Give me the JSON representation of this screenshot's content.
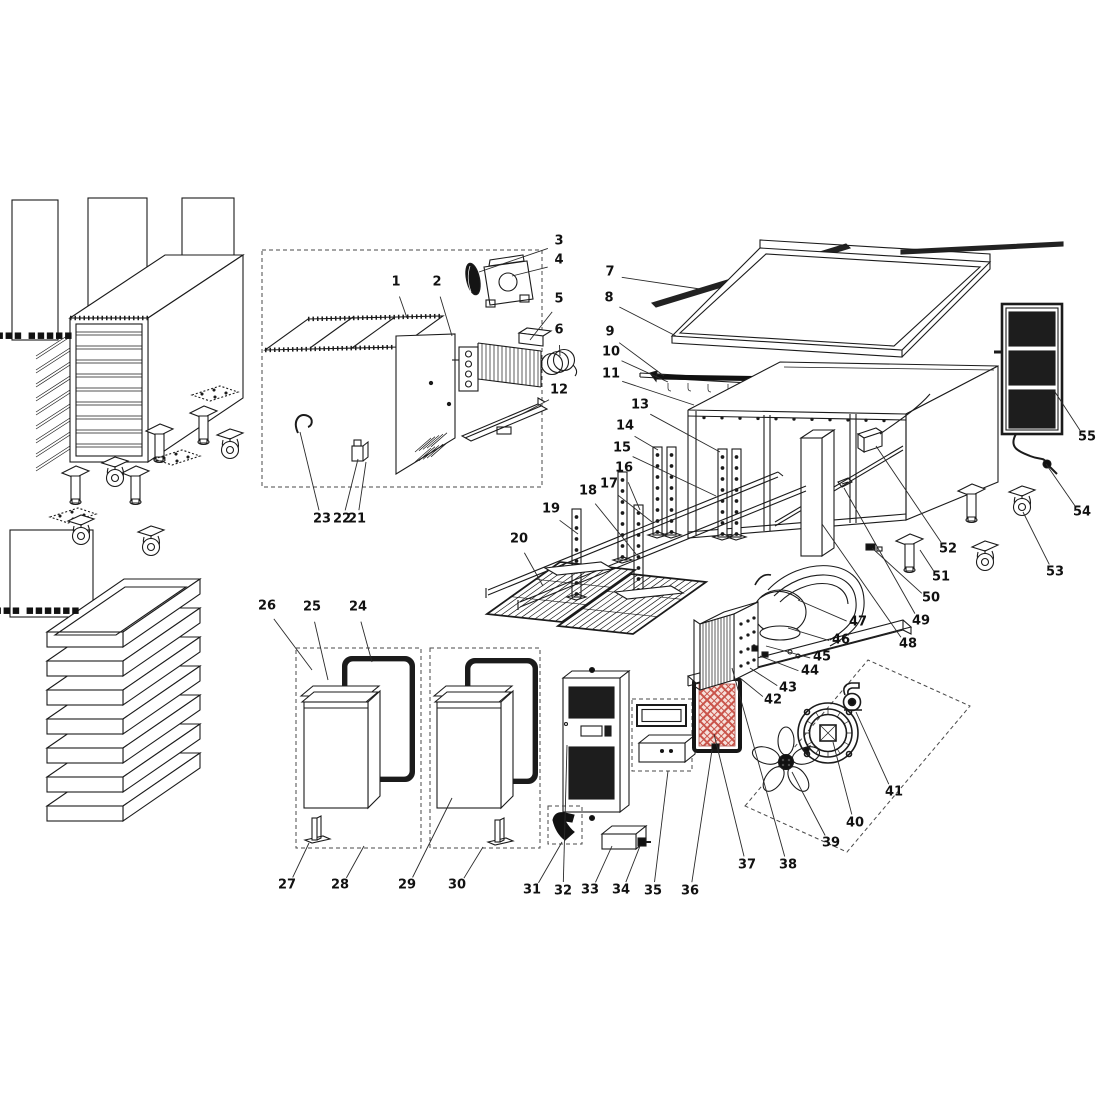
{
  "canvas": {
    "width": 1100,
    "height": 1100,
    "background": "#ffffff",
    "line_color": "#1b1b1b",
    "leader_color": "#2a2a2a",
    "label_color": "#111111",
    "filter_lattice_red": "#c9544a",
    "filter_lattice_bg": "#f6e0da",
    "mesh_dark": "#1d1d1d"
  },
  "diagram": {
    "kind": "exploded-parts-diagram",
    "subject": "commercial refrigerated worktable exploded view",
    "projection": "isometric technical line drawing",
    "part_count": 55
  },
  "fine_print": [
    {
      "text": "▪▪▪▪▪▪▪ ▪▪▪▪▪",
      "x": 16,
      "y": 339
    },
    {
      "text": "▪▪▪▪▪▪▪▪ ▪▪▪▪▪▪",
      "x": 14,
      "y": 614
    }
  ],
  "parts": [
    {
      "n": "1",
      "x": 396,
      "y": 281,
      "tx": 407,
      "ty": 318
    },
    {
      "n": "2",
      "x": 437,
      "y": 281,
      "tx": 452,
      "ty": 336
    },
    {
      "n": "3",
      "x": 559,
      "y": 240,
      "tx": 479,
      "ty": 272
    },
    {
      "n": "4",
      "x": 559,
      "y": 259,
      "tx": 512,
      "ty": 276
    },
    {
      "n": "5",
      "x": 559,
      "y": 298,
      "tx": 530,
      "ty": 340
    },
    {
      "n": "6",
      "x": 559,
      "y": 329,
      "tx": 560,
      "ty": 356
    },
    {
      "n": "7",
      "x": 610,
      "y": 271,
      "tx": 700,
      "ty": 289
    },
    {
      "n": "8",
      "x": 609,
      "y": 297,
      "tx": 676,
      "ty": 336
    },
    {
      "n": "9",
      "x": 610,
      "y": 331,
      "tx": 664,
      "ty": 376
    },
    {
      "n": "10",
      "x": 611,
      "y": 351,
      "tx": 668,
      "ty": 382
    },
    {
      "n": "11",
      "x": 611,
      "y": 373,
      "tx": 694,
      "ty": 405
    },
    {
      "n": "12",
      "x": 559,
      "y": 389,
      "tx": 522,
      "ty": 414
    },
    {
      "n": "13",
      "x": 640,
      "y": 404,
      "tx": 720,
      "ty": 452
    },
    {
      "n": "14",
      "x": 625,
      "y": 425,
      "tx": 658,
      "ty": 450
    },
    {
      "n": "15",
      "x": 622,
      "y": 447,
      "tx": 716,
      "ty": 496
    },
    {
      "n": "16",
      "x": 624,
      "y": 467,
      "tx": 640,
      "ty": 510
    },
    {
      "n": "17",
      "x": 609,
      "y": 483,
      "tx": 652,
      "ty": 522
    },
    {
      "n": "18",
      "x": 588,
      "y": 490,
      "tx": 636,
      "ty": 554
    },
    {
      "n": "19",
      "x": 551,
      "y": 508,
      "tx": 578,
      "ty": 534
    },
    {
      "n": "20",
      "x": 519,
      "y": 538,
      "tx": 543,
      "ty": 586
    },
    {
      "n": "21",
      "x": 357,
      "y": 518,
      "tx": 366,
      "ty": 462
    },
    {
      "n": "22",
      "x": 342,
      "y": 518,
      "tx": 358,
      "ty": 459
    },
    {
      "n": "23",
      "x": 322,
      "y": 518,
      "tx": 300,
      "ty": 432
    },
    {
      "n": "24",
      "x": 358,
      "y": 606,
      "tx": 372,
      "ty": 662
    },
    {
      "n": "25",
      "x": 312,
      "y": 606,
      "tx": 328,
      "ty": 680
    },
    {
      "n": "26",
      "x": 267,
      "y": 605,
      "tx": 312,
      "ty": 670
    },
    {
      "n": "27",
      "x": 287,
      "y": 884,
      "tx": 309,
      "ty": 843
    },
    {
      "n": "28",
      "x": 340,
      "y": 884,
      "tx": 364,
      "ty": 846
    },
    {
      "n": "29",
      "x": 407,
      "y": 884,
      "tx": 452,
      "ty": 798
    },
    {
      "n": "30",
      "x": 457,
      "y": 884,
      "tx": 483,
      "ty": 847
    },
    {
      "n": "31",
      "x": 532,
      "y": 889,
      "tx": 562,
      "ty": 842
    },
    {
      "n": "32",
      "x": 563,
      "y": 890,
      "tx": 567,
      "ty": 745
    },
    {
      "n": "33",
      "x": 590,
      "y": 889,
      "tx": 612,
      "ty": 846
    },
    {
      "n": "34",
      "x": 621,
      "y": 889,
      "tx": 640,
      "ty": 846
    },
    {
      "n": "35",
      "x": 653,
      "y": 890,
      "tx": 668,
      "ty": 771
    },
    {
      "n": "36",
      "x": 690,
      "y": 890,
      "tx": 712,
      "ty": 750
    },
    {
      "n": "37",
      "x": 747,
      "y": 864,
      "tx": 714,
      "ty": 734
    },
    {
      "n": "38",
      "x": 788,
      "y": 864,
      "tx": 732,
      "ty": 668
    },
    {
      "n": "39",
      "x": 831,
      "y": 842,
      "tx": 792,
      "ty": 772
    },
    {
      "n": "40",
      "x": 855,
      "y": 822,
      "tx": 833,
      "ty": 742
    },
    {
      "n": "41",
      "x": 894,
      "y": 791,
      "tx": 856,
      "ty": 712
    },
    {
      "n": "42",
      "x": 773,
      "y": 699,
      "tx": 740,
      "ty": 678
    },
    {
      "n": "43",
      "x": 788,
      "y": 687,
      "tx": 750,
      "ty": 668
    },
    {
      "n": "44",
      "x": 810,
      "y": 670,
      "tx": 760,
      "ty": 656
    },
    {
      "n": "45",
      "x": 822,
      "y": 656,
      "tx": 766,
      "ty": 646
    },
    {
      "n": "46",
      "x": 841,
      "y": 639,
      "tx": 788,
      "ty": 628
    },
    {
      "n": "47",
      "x": 858,
      "y": 621,
      "tx": 798,
      "ty": 600
    },
    {
      "n": "48",
      "x": 908,
      "y": 643,
      "tx": 822,
      "ty": 524
    },
    {
      "n": "49",
      "x": 921,
      "y": 620,
      "tx": 844,
      "ty": 488
    },
    {
      "n": "50",
      "x": 931,
      "y": 597,
      "tx": 872,
      "ty": 548
    },
    {
      "n": "51",
      "x": 941,
      "y": 576,
      "tx": 920,
      "ty": 550
    },
    {
      "n": "52",
      "x": 948,
      "y": 548,
      "tx": 876,
      "ty": 446
    },
    {
      "n": "53",
      "x": 1055,
      "y": 571,
      "tx": 1023,
      "ty": 512
    },
    {
      "n": "54",
      "x": 1082,
      "y": 511,
      "tx": 1046,
      "ty": 464
    },
    {
      "n": "55",
      "x": 1087,
      "y": 436,
      "tx": 1055,
      "ty": 392
    }
  ]
}
